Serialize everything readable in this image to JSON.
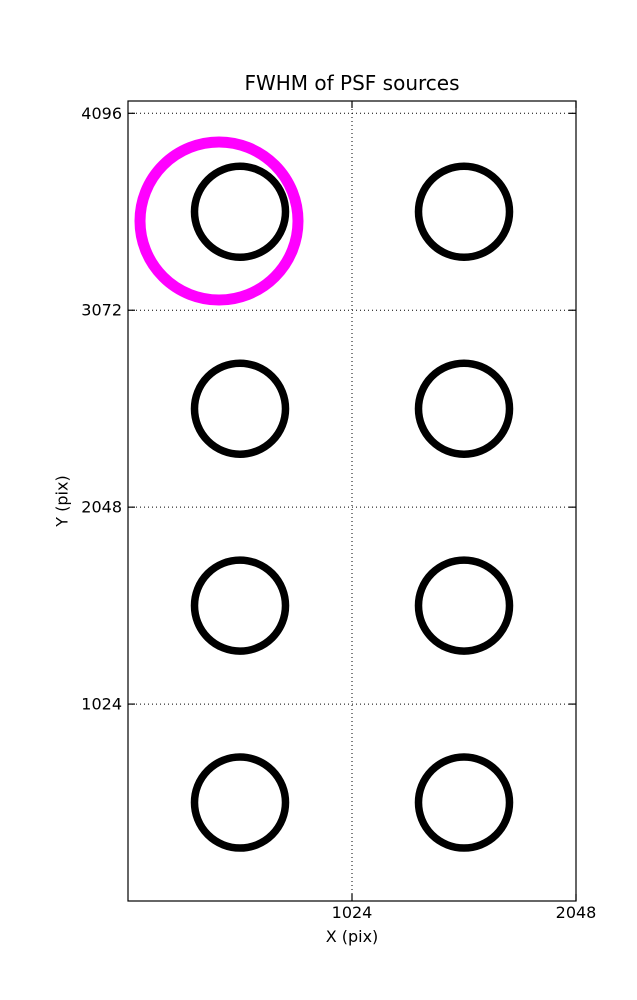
{
  "figure": {
    "background": "#ffffff"
  },
  "chart_data": {
    "type": "scatter",
    "title": "FWHM of PSF sources",
    "xlabel": "X (pix)",
    "ylabel": "Y (pix)",
    "xlim": [
      0,
      2048
    ],
    "ylim": [
      0,
      4160
    ],
    "xticks": [
      1024,
      2048
    ],
    "yticks": [
      1024,
      2048,
      3072,
      4096
    ],
    "grid": {
      "style": "dotted",
      "color": "#000000",
      "x_at": [
        1024
      ],
      "y_at": [
        1024,
        2048,
        3072,
        4096
      ]
    },
    "legend": "none",
    "series": [
      {
        "name": "psf-source",
        "color": "#000000",
        "marker": "open-circle",
        "marker_radius_px": 45.5,
        "stroke_px": 7.5,
        "points": [
          [
            512,
            3584
          ],
          [
            1536,
            3584
          ],
          [
            512,
            2560
          ],
          [
            1536,
            2560
          ],
          [
            512,
            1536
          ],
          [
            1536,
            1536
          ],
          [
            512,
            512
          ],
          [
            1536,
            512
          ]
        ]
      },
      {
        "name": "highlight",
        "color": "#ff00ff",
        "marker": "open-circle",
        "marker_radius_px": 79,
        "stroke_px": 11,
        "points": [
          [
            416,
            3536
          ]
        ]
      }
    ]
  }
}
